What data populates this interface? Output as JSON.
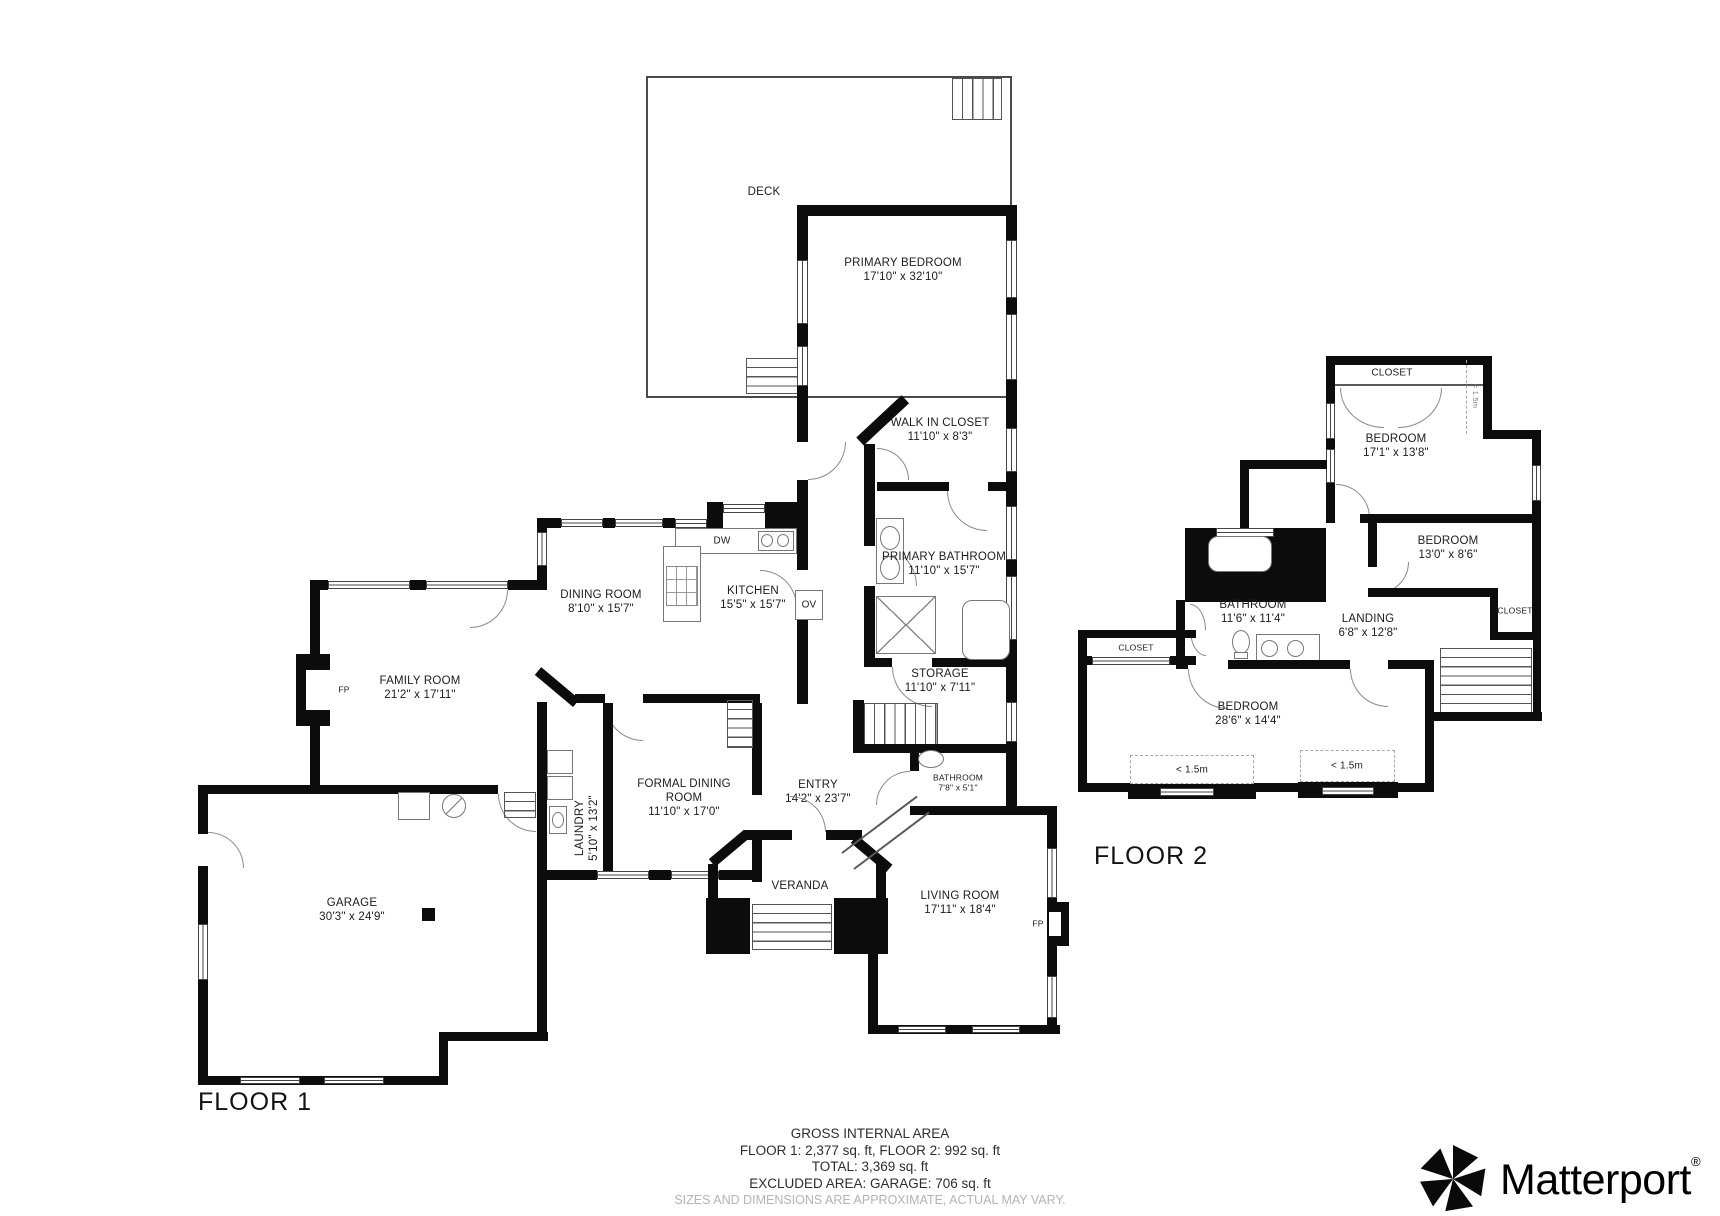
{
  "floor1": {
    "label": "FLOOR 1",
    "rooms": {
      "deck": {
        "name": "DECK"
      },
      "primary_bedroom": {
        "name": "PRIMARY BEDROOM",
        "dims": "17'10\" x 32'10\""
      },
      "walk_in_closet": {
        "name": "WALK IN CLOSET",
        "dims": "11'10\" x 8'3\""
      },
      "primary_bathroom": {
        "name": "PRIMARY BATHROOM",
        "dims": "11'10\" x 15'7\""
      },
      "dining_room": {
        "name": "DINING ROOM",
        "dims": "8'10\" x 15'7\""
      },
      "kitchen": {
        "name": "KITCHEN",
        "dims": "15'5\" x 15'7\""
      },
      "family_room": {
        "name": "FAMILY ROOM",
        "dims": "21'2\" x 17'11\""
      },
      "storage": {
        "name": "STORAGE",
        "dims": "11'10\" x 7'11\""
      },
      "formal_dining_room": {
        "name": "FORMAL DINING ROOM",
        "dims": "11'10\" x 17'0\""
      },
      "entry": {
        "name": "ENTRY",
        "dims": "14'2\" x 23'7\""
      },
      "laundry": {
        "name": "LAUNDRY",
        "dims": "5'10\" x 13'2\""
      },
      "garage": {
        "name": "GARAGE",
        "dims": "30'3\" x 24'9\""
      },
      "veranda": {
        "name": "VERANDA"
      },
      "bathroom": {
        "name": "BATHROOM",
        "dims": "7'8\" x 5'1\""
      },
      "living_room": {
        "name": "LIVING ROOM",
        "dims": "17'11\" x 18'4\""
      }
    },
    "annotations": {
      "fireplace": "FP",
      "dishwasher": "DW",
      "oven": "OV"
    }
  },
  "floor2": {
    "label": "FLOOR 2",
    "rooms": {
      "closet_top": {
        "name": "CLOSET"
      },
      "bedroom_large": {
        "name": "BEDROOM",
        "dims": "17'1\" x 13'8\""
      },
      "bedroom_small": {
        "name": "BEDROOM",
        "dims": "13'0\" x 8'6\""
      },
      "closet_right": {
        "name": "CLOSET"
      },
      "bathroom": {
        "name": "BATHROOM",
        "dims": "11'6\" x 11'4\""
      },
      "landing": {
        "name": "LANDING",
        "dims": "6'8\" x 12'8\""
      },
      "closet_left": {
        "name": "CLOSET"
      },
      "bedroom_wide": {
        "name": "BEDROOM",
        "dims": "28'6\" x 14'4\""
      }
    },
    "clearances": {
      "side": "< 1.5m",
      "left": "< 1.5m",
      "right": "< 1.5m"
    }
  },
  "footer": {
    "title": "GROSS INTERNAL AREA",
    "floors": "FLOOR 1: 2,377 sq. ft, FLOOR 2: 992 sq. ft",
    "total": "TOTAL: 3,369 sq. ft",
    "excluded": "EXCLUDED AREA: GARAGE: 706 sq. ft",
    "disclaimer": "SIZES AND DIMENSIONS ARE APPROXIMATE, ACTUAL MAY VARY."
  },
  "branding": {
    "wordmark": "Matterport",
    "registered": "®"
  }
}
